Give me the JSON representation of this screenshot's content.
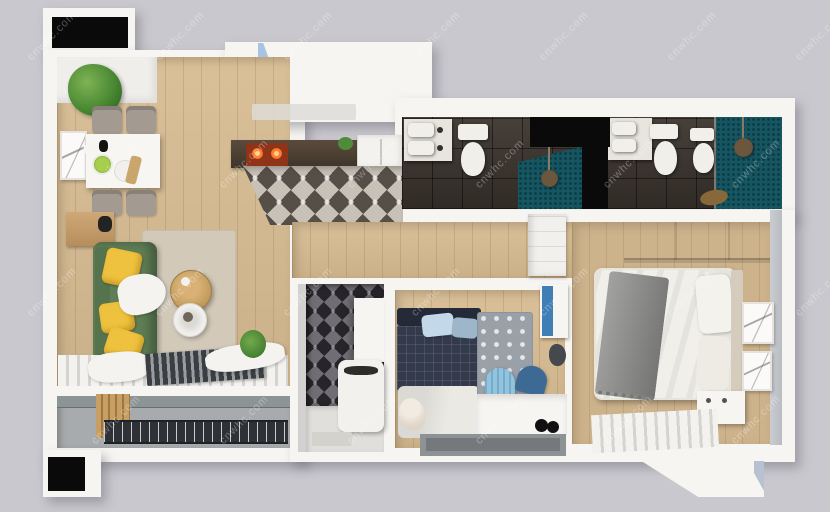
{
  "scene": {
    "description": "3D rendered top-down axonometric floor plan of an apartment",
    "rooms": [
      {
        "id": "living-dining-room",
        "floor": "light-wood-planks",
        "furniture": [
          "dining-table",
          "four-gray-chairs",
          "potted-plant",
          "wall-art",
          "green-sofa",
          "yellow-cushions",
          "white-throw",
          "round-wood-coffee-table",
          "round-white-side-table",
          "beige-rug",
          "wood-bench",
          "window-blinds",
          "radiator"
        ]
      },
      {
        "id": "kitchen",
        "floor": "patterned-cement-tiles",
        "furniture": [
          "dark-countertop",
          "stove-with-hot-burners",
          "range-hood",
          "fridge",
          "herb-plant"
        ]
      },
      {
        "id": "bathroom-1",
        "floor": "dark-stone-tiles",
        "furniture": [
          "double-sink-vanity",
          "toilet",
          "teal-mosaic-shower",
          "rain-shower-head"
        ]
      },
      {
        "id": "bathroom-2",
        "floor": "dark-stone-tiles",
        "furniture": [
          "vanity-sink",
          "toilet",
          "bidet",
          "teal-mosaic-shower",
          "rain-shower-head",
          "towel"
        ]
      },
      {
        "id": "master-bedroom",
        "floor": "wood-planks",
        "furniture": [
          "double-bed",
          "gray-throw-blanket",
          "pillows",
          "headboard",
          "sliding-wardrobe",
          "two-wall-art-frames",
          "nightstand",
          "radiator"
        ]
      },
      {
        "id": "kids-room",
        "floor": "wood-planks",
        "furniture": [
          "navy-plaid-bed",
          "light-blue-pillows",
          "white-blanket",
          "teddy-bear",
          "polka-dot-rug",
          "light-blue-chair",
          "dark-blue-chair",
          "white-desk",
          "gray-desktop",
          "blue-wall-cabinet",
          "hanging-bag",
          "headphones"
        ]
      },
      {
        "id": "laundry-wc",
        "floor": "light-tiles",
        "furniture": [
          "patterned-tile-wall",
          "white-appliance",
          "wall-cabinet"
        ]
      },
      {
        "id": "balcony",
        "floor": "concrete",
        "furniture": [
          "metal-drying-grate",
          "wood-decking"
        ]
      }
    ],
    "windows": [
      "black-window-top-left",
      "black-window-bottom-left",
      "blue-glass-panel-top",
      "black-glazing-bathroom-corner"
    ]
  },
  "watermark": {
    "text": "cnwhc.com",
    "opacity": 0.3,
    "positions": [
      [
        20,
        30
      ],
      [
        148,
        30
      ],
      [
        276,
        30
      ],
      [
        404,
        30
      ],
      [
        532,
        30
      ],
      [
        660,
        30
      ],
      [
        788,
        30
      ],
      [
        84,
        158
      ],
      [
        212,
        158
      ],
      [
        340,
        158
      ],
      [
        468,
        158
      ],
      [
        596,
        158
      ],
      [
        724,
        158
      ],
      [
        20,
        286
      ],
      [
        148,
        286
      ],
      [
        276,
        286
      ],
      [
        404,
        286
      ],
      [
        532,
        286
      ],
      [
        660,
        286
      ],
      [
        788,
        286
      ],
      [
        84,
        414
      ],
      [
        212,
        414
      ],
      [
        340,
        414
      ],
      [
        468,
        414
      ],
      [
        596,
        414
      ],
      [
        724,
        414
      ]
    ]
  },
  "colors": {
    "bg": "#c9c8ce",
    "wall": "#f6f5f2",
    "black": "#0a0a0a",
    "glass": "#a9c3e2",
    "wood": "#d7bc92",
    "wood2": "#cdb38c",
    "rug": "#d2c9b9",
    "sofa": "#5f7e55",
    "yellow": "#eec23e",
    "teal": "#155662",
    "concrete": "#a8abad",
    "concrete2": "#8d9495",
    "navy": "#333a4c",
    "kidpillow": "#c3d9e9",
    "chairlight": "#8fc5de",
    "chairdark": "#3c6a94",
    "cabinetblue": "#3f7fb5",
    "stove": "#8f3418",
    "counter": "#4e4338",
    "graythrow": "#8e8e8c",
    "wardrobe": "#ccd0d3"
  }
}
